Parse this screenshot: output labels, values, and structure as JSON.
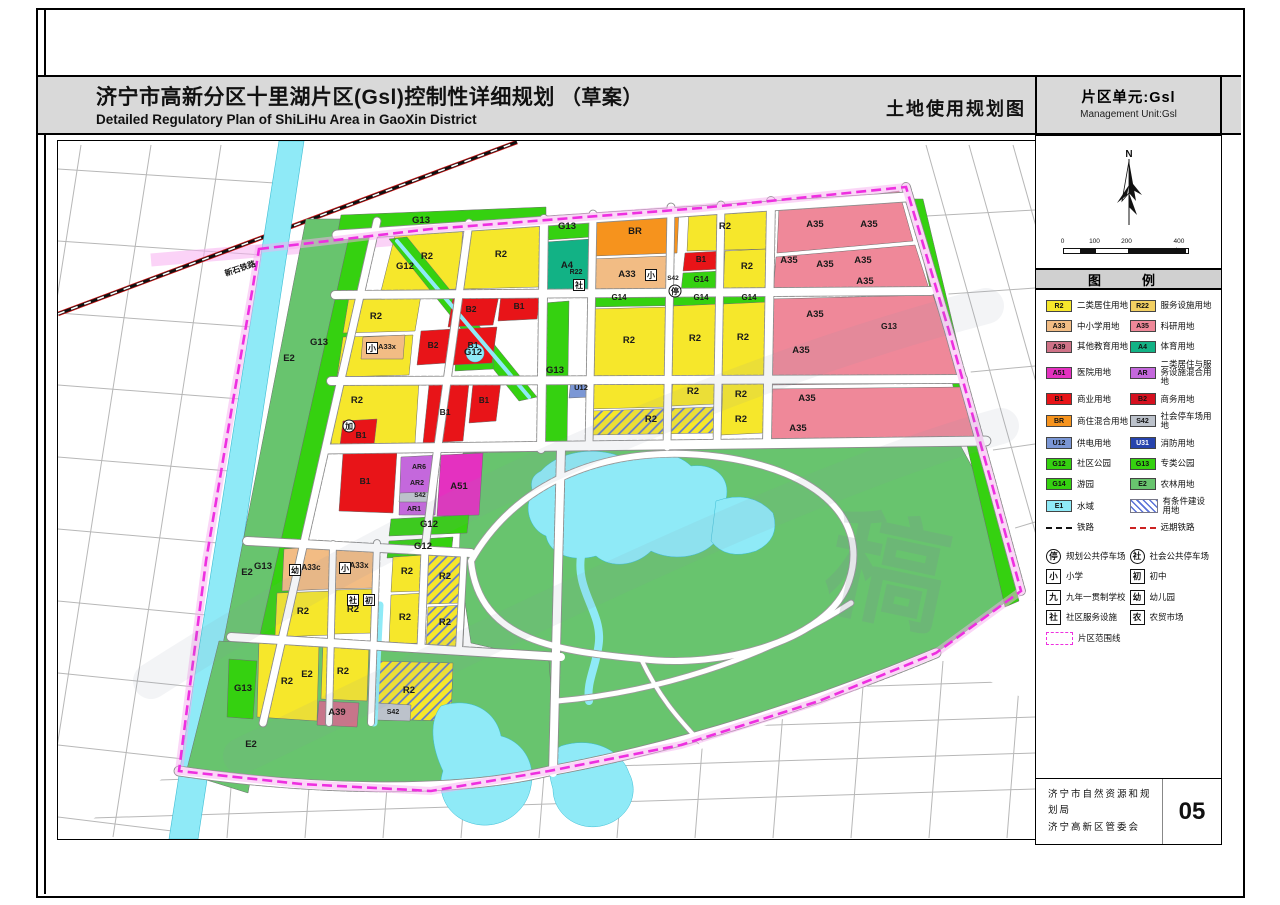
{
  "header": {
    "title_cn": "济宁市高新分区十里湖片区(Gsl)控制性详细规划",
    "title_draft": "（草案）",
    "title_en": "Detailed Regulatory Plan of ShiLiHu Area in GaoXin District",
    "map_name": "土地使用规划图",
    "unit_cn": "片区单元:Gsl",
    "unit_en": "Management Unit:Gsl"
  },
  "compass": {
    "north_label": "N"
  },
  "scale": {
    "labels": [
      {
        "t": "0",
        "x": 0
      },
      {
        "t": "100",
        "x": 32
      },
      {
        "t": "200",
        "x": 64
      },
      {
        "t": "400米",
        "x": 118
      }
    ],
    "segments": [
      {
        "w": 16,
        "b": 0
      },
      {
        "w": 16,
        "b": 1
      },
      {
        "w": 32,
        "b": 0
      },
      {
        "w": 58,
        "b": 1
      }
    ]
  },
  "legend": {
    "title": "图　例",
    "rows": [
      [
        {
          "code": "R2",
          "color": "#f6e72b",
          "label": "二类居住用地"
        },
        {
          "code": "R22",
          "color": "#f2cf62",
          "label": "服务设施用地"
        }
      ],
      [
        {
          "code": "A33",
          "color": "#f2bc84",
          "label": "中小学用地"
        },
        {
          "code": "A35",
          "color": "#ef8899",
          "label": "科研用地"
        }
      ],
      [
        {
          "code": "A39",
          "color": "#cf7287",
          "label": "其他教育用地"
        },
        {
          "code": "A4",
          "color": "#12b285",
          "label": "体育用地"
        }
      ],
      [
        {
          "code": "A51",
          "color": "#e431c0",
          "label": "医院用地"
        },
        {
          "code": "AR",
          "color": "#c468dc",
          "label": "二类居住与服务设施混合用地"
        }
      ],
      [
        {
          "code": "B1",
          "color": "#e81418",
          "label": "商业用地"
        },
        {
          "code": "B2",
          "color": "#d5101f",
          "label": "商务用地"
        }
      ],
      [
        {
          "code": "BR",
          "color": "#f6931d",
          "label": "商住混合用地"
        },
        {
          "code": "S42",
          "color": "#bcc2cb",
          "label": "社会停车场用地"
        }
      ],
      [
        {
          "code": "U12",
          "color": "#7b97d5",
          "label": "供电用地"
        },
        {
          "code": "U31",
          "color": "#2743ad",
          "label": "消防用地",
          "white": 1
        }
      ],
      [
        {
          "code": "G12",
          "color": "#35d110",
          "label": "社区公园"
        },
        {
          "code": "G13",
          "color": "#35d110",
          "label": "专类公园"
        }
      ],
      [
        {
          "code": "G14",
          "color": "#35d110",
          "label": "游园"
        },
        {
          "code": "E2",
          "color": "#68c46e",
          "label": "农林用地"
        }
      ],
      [
        {
          "code": "E1",
          "color": "#8feaf7",
          "label": "水域"
        },
        {
          "type": "hatch",
          "label": "有条件建设用地"
        }
      ],
      [
        {
          "type": "line-black",
          "label": "铁路"
        },
        {
          "type": "line-red",
          "label": "远期铁路"
        }
      ]
    ],
    "symbols": [
      [
        {
          "sym": "停",
          "circ": 1,
          "label": "规划公共停车场"
        },
        {
          "sym": "社",
          "circ": 1,
          "label": "社会公共停车场"
        }
      ],
      [
        {
          "sym": "小",
          "label": "小学"
        },
        {
          "sym": "初",
          "label": "初中"
        }
      ],
      [
        {
          "sym": "九",
          "label": "九年一贯制学校"
        },
        {
          "sym": "幼",
          "label": "幼儿园"
        }
      ],
      [
        {
          "sym": "社",
          "label": "社区服务设施"
        },
        {
          "sym": "农",
          "label": "农贸市场"
        }
      ]
    ],
    "boundary_item": {
      "label": "片区范围线"
    }
  },
  "footer": {
    "org1": "济宁市自然资源和规划局",
    "org2": "济宁高新区管委会",
    "page": "05"
  },
  "map": {
    "palette": {
      "R2": "#f6e72b",
      "R22": "#f2cf62",
      "A33": "#f2bc84",
      "A39": "#cf7287",
      "A35": "#ef8899",
      "A4": "#12b285",
      "A51": "#e431c0",
      "AR": "#c468dc",
      "B": "#e81418",
      "BR": "#f6931d",
      "S42": "#bcc2cb",
      "U12": "#7b97d5",
      "U31": "#2743ad",
      "G": "#35d110",
      "E2": "#68c46e",
      "E1": "#8feaf7",
      "bnd": "#ee2fe0",
      "bndBand": "#f8aef0",
      "rail": "#cf1212",
      "grid": "#b7b7b7",
      "hatch": "#5a72d8"
    },
    "river": "278,140 303,140 197,838 168,838",
    "railway": "M57,313 L516,141",
    "corridor": "M150,259 L562,224",
    "boundary": "M258,248 L430,228 L700,207 L905,186 L948,330 L990,480 L1020,590 L935,652 L818,700 L680,744 L548,770 L430,790 L300,783 L178,770 L205,560 L232,400 L252,285 Z",
    "parcels": [
      {
        "p": "305,218 352,218 247,792 196,776",
        "c": "E2"
      },
      {
        "p": "352,218 376,218 262,724 240,718",
        "c": "G"
      },
      {
        "d": "M218,640 L470,655 L560,660 L548,768 L430,790 L300,783 L185,772 Z",
        "c": "E2"
      },
      {
        "d": "M462,452 L958,442 L1002,522 L1020,590 L935,652 L818,700 L680,744 L556,770 L548,660 L470,642 L458,560 Z",
        "c": "E2"
      },
      {
        "p": "340,214 545,206 545,224 336,236",
        "c": "G"
      },
      {
        "d": "M908,198 L922,198 L1018,600 L1004,606 Z",
        "c": "G"
      },
      {
        "p": "545,216 590,213 590,236 545,239",
        "c": "G"
      },
      {
        "p": "543,302 568,300 566,444 541,446",
        "c": "G"
      },
      {
        "p": "228,658 256,660 252,718 226,716",
        "c": "G"
      },
      {
        "p": "396,226 462,224 458,288 380,290",
        "c": "R2"
      },
      {
        "p": "466,224 540,222 538,286 462,288",
        "c": "R2"
      },
      {
        "p": "348,296 420,294 414,330 342,332",
        "c": "R2"
      },
      {
        "p": "342,336 412,334 408,374 336,376",
        "c": "R2"
      },
      {
        "p": "362,336 404,334 402,358 360,358",
        "c": "A33"
      },
      {
        "p": "336,382 418,380 414,442 330,444",
        "c": "R2"
      },
      {
        "p": "342,420 376,418 373,444 339,444",
        "c": "B"
      },
      {
        "d": "M388,238 L406,236 L536,396 L518,400 Z",
        "c": "G"
      },
      {
        "p": "456,338 494,336 492,368 454,370",
        "c": "G"
      },
      {
        "p": "452,296 498,294 492,324 447,326",
        "c": "B"
      },
      {
        "p": "500,294 540,292 536,318 497,320",
        "c": "B"
      },
      {
        "p": "420,330 452,328 446,362 416,364",
        "c": "B"
      },
      {
        "p": "455,328 496,326 491,362 451,364",
        "c": "B"
      },
      {
        "p": "428,384 468,382 462,440 422,442",
        "c": "B"
      },
      {
        "p": "472,382 500,380 495,420 468,422",
        "c": "B"
      },
      {
        "p": "342,452 396,450 392,512 338,510",
        "c": "B"
      },
      {
        "p": "400,456 438,454 434,514 398,514",
        "c": "AR"
      },
      {
        "p": "399,492 434,491 433,501 398,501",
        "c": "S42"
      },
      {
        "p": "440,454 482,452 478,514 436,515",
        "c": "A51"
      },
      {
        "p": "390,518 468,514 466,532 388,535",
        "c": "G"
      },
      {
        "p": "388,540 452,536 450,554 386,557",
        "c": "G"
      },
      {
        "p": "595,212 678,208 676,252 593,255",
        "c": "BR"
      },
      {
        "p": "688,207 768,202 766,248 686,250",
        "c": "R2"
      },
      {
        "p": "684,252 722,250 720,268 682,270",
        "c": "B"
      },
      {
        "p": "682,272 720,270 718,290 680,291",
        "c": "G"
      },
      {
        "p": "724,250 766,248 764,288 722,290",
        "c": "R2"
      },
      {
        "p": "590,258 668,255 666,290 588,292",
        "c": "A33"
      },
      {
        "p": "566,260 588,258 586,291 564,292",
        "c": "R22"
      },
      {
        "p": "545,241 590,238 588,290 543,292",
        "c": "A4"
      },
      {
        "p": "590,294 768,290 766,303 588,306",
        "c": "G"
      },
      {
        "p": "590,308 668,306 666,376 588,378",
        "c": "R2"
      },
      {
        "p": "672,305 718,303 716,375 670,377",
        "c": "R2"
      },
      {
        "p": "722,303 766,301 764,374 720,376",
        "c": "R2"
      },
      {
        "p": "590,382 668,380 666,406 588,408",
        "c": "R2"
      },
      {
        "p": "590,410 716,406 714,432 588,434",
        "c": "R2",
        "h": 1
      },
      {
        "p": "672,379 716,377 714,403 670,405",
        "c": "R2"
      },
      {
        "p": "722,379 764,377 762,432 720,434",
        "c": "R2"
      },
      {
        "p": "570,378 592,376 590,396 568,397",
        "c": "U12"
      },
      {
        "p": "778,206 898,190 912,240 776,252",
        "c": "A35"
      },
      {
        "p": "775,256 914,244 928,288 772,294",
        "c": "A35"
      },
      {
        "p": "770,298 932,294 962,382 768,384",
        "c": "A35"
      },
      {
        "p": "768,388 963,386 976,436 766,440",
        "c": "A35"
      },
      {
        "p": "283,548 330,545 328,588 281,590",
        "c": "A33"
      },
      {
        "p": "335,545 375,543 373,587 333,588",
        "c": "A33"
      },
      {
        "p": "276,592 332,590 330,634 274,636",
        "c": "R2"
      },
      {
        "p": "335,589 374,588 372,632 333,633",
        "c": "R2"
      },
      {
        "p": "392,556 424,554 422,590 390,591",
        "c": "R2"
      },
      {
        "p": "427,553 464,551 462,602 425,603",
        "c": "R2",
        "h": 1
      },
      {
        "p": "390,594 424,592 422,642 388,643",
        "c": "R2"
      },
      {
        "p": "427,606 464,604 462,645 425,646",
        "c": "R2",
        "h": 1
      },
      {
        "p": "258,640 318,643 316,720 256,716",
        "c": "R2"
      },
      {
        "p": "322,643 368,645 366,700 320,698",
        "c": "R2"
      },
      {
        "p": "318,700 358,702 356,726 316,724",
        "c": "A39"
      },
      {
        "p": "372,660 452,662 450,720 370,718",
        "c": "R2",
        "h": 1
      },
      {
        "p": "376,702 410,704 409,720 375,719",
        "c": "S42"
      }
    ],
    "water": [
      {
        "d": "M396,240 L528,396",
        "w": 4
      },
      {
        "d": "M379,604 L373,722",
        "w": 7
      },
      {
        "d": "M540,470 C560,448 600,445 625,458 C645,448 675,450 690,465 C715,462 730,478 725,498 C740,512 735,532 715,540 C700,558 670,560 650,550 C635,565 610,568 595,555 C570,562 548,552 545,535 C528,528 522,505 532,492 C528,480 532,474 540,470 Z"
      },
      {
        "d": "M715,500 Q750,488 772,512 Q780,538 755,550 Q725,560 710,540 Z"
      },
      {
        "d": "M580,555 C575,590 600,610 598,640 C596,665 585,680 588,700",
        "w": 8
      },
      {
        "d": "M440,705 C470,695 495,710 500,735 C520,740 535,760 530,785 C525,815 495,830 470,822 C445,815 435,790 442,770 C430,745 428,720 440,705 Z"
      },
      {
        "d": "M560,745 C590,735 620,748 628,772 C640,795 625,820 600,825 C575,830 552,812 552,788 C545,765 548,752 560,745 Z"
      },
      {
        "d": "M474,343 a9,9 0 1,0 0.1,0 Z"
      }
    ],
    "roads": [
      {
        "d": "M336,234 L905,196",
        "w": 9
      },
      {
        "d": "M334,294 L930,290",
        "w": 8
      },
      {
        "d": "M330,380 L962,378",
        "w": 8
      },
      {
        "d": "M326,448 L985,440",
        "w": 9
      },
      {
        "d": "M376,220 L262,722",
        "w": 7
      },
      {
        "d": "M468,222 L436,452 L424,548 L420,645",
        "w": 7
      },
      {
        "d": "M543,218 L540,448",
        "w": 8
      },
      {
        "d": "M592,213 L588,446",
        "w": 7
      },
      {
        "d": "M670,206 L666,446",
        "w": 7
      },
      {
        "d": "M720,204 L716,444",
        "w": 7
      },
      {
        "d": "M770,200 L766,442",
        "w": 8
      },
      {
        "d": "M246,540 L470,552",
        "w": 8
      },
      {
        "d": "M230,636 L560,656",
        "w": 8
      },
      {
        "d": "M332,543 L328,722",
        "w": 6
      },
      {
        "d": "M376,542 L370,722",
        "w": 6
      },
      {
        "d": "M463,552 L458,648",
        "w": 6
      },
      {
        "d": "M560,448 L552,772",
        "w": 8
      },
      {
        "d": "M178,770 C300,788 450,794 548,770 C680,746 820,700 935,652",
        "w": 9
      },
      {
        "d": "M905,186 L948,330 L990,480 L1020,590",
        "w": 8
      },
      {
        "d": "M470,560 C520,472 620,442 720,456 C820,470 868,520 848,580 C828,640 720,668 640,658 C560,650 478,642 470,560",
        "w": 6,
        "p": 1
      },
      {
        "d": "M556,700 C650,692 760,660 850,602",
        "w": 5,
        "p": 1
      },
      {
        "d": "M640,658 C660,700 680,720 700,742",
        "w": 4,
        "p": 1
      }
    ],
    "labels": [
      [
        "G13",
        420,
        222
      ],
      [
        "G13",
        318,
        344
      ],
      [
        "G13",
        262,
        568
      ],
      [
        "G13",
        242,
        690
      ],
      [
        "G13",
        554,
        372
      ],
      [
        "G13",
        566,
        228
      ],
      [
        "G13",
        888,
        328,
        8.5
      ],
      [
        "E2",
        288,
        360
      ],
      [
        "E2",
        246,
        574
      ],
      [
        "E2",
        250,
        746
      ],
      [
        "E2",
        306,
        676
      ],
      [
        "G12",
        404,
        268
      ],
      [
        "G12",
        472,
        354
      ],
      [
        "G12",
        428,
        526
      ],
      [
        "G12",
        422,
        548
      ],
      [
        "G14",
        618,
        299,
        8
      ],
      [
        "G14",
        700,
        281,
        8
      ],
      [
        "G14",
        700,
        299,
        8
      ],
      [
        "G14",
        748,
        299,
        8
      ],
      [
        "A4",
        566,
        267
      ],
      [
        "R2",
        426,
        258
      ],
      [
        "R2",
        500,
        256
      ],
      [
        "R2",
        375,
        318
      ],
      [
        "R2",
        356,
        402
      ],
      [
        "R2",
        302,
        613
      ],
      [
        "R2",
        352,
        611
      ],
      [
        "R2",
        406,
        573
      ],
      [
        "R2",
        444,
        578
      ],
      [
        "R2",
        404,
        619
      ],
      [
        "R2",
        444,
        624
      ],
      [
        "R2",
        286,
        683
      ],
      [
        "R2",
        342,
        673
      ],
      [
        "R2",
        408,
        692
      ],
      [
        "R2",
        628,
        342
      ],
      [
        "R2",
        694,
        340
      ],
      [
        "R2",
        742,
        339
      ],
      [
        "R2",
        692,
        393
      ],
      [
        "R2",
        740,
        396
      ],
      [
        "R2",
        650,
        421
      ],
      [
        "R2",
        740,
        421
      ],
      [
        "R2",
        724,
        228
      ],
      [
        "R2",
        746,
        268
      ],
      [
        "A35",
        814,
        226
      ],
      [
        "A35",
        868,
        226
      ],
      [
        "A35",
        788,
        262
      ],
      [
        "A35",
        824,
        266
      ],
      [
        "A35",
        862,
        262
      ],
      [
        "A35",
        864,
        283
      ],
      [
        "A35",
        814,
        316
      ],
      [
        "A35",
        800,
        352
      ],
      [
        "A35",
        806,
        400
      ],
      [
        "A35",
        797,
        430
      ],
      [
        "B2",
        470,
        311,
        8.5
      ],
      [
        "B1",
        518,
        308,
        8.5
      ],
      [
        "B2",
        432,
        347,
        8.5
      ],
      [
        "B1",
        472,
        347,
        8.5
      ],
      [
        "B1",
        360,
        437,
        8.5
      ],
      [
        "B1",
        444,
        414,
        8.5
      ],
      [
        "B1",
        483,
        402,
        8
      ],
      [
        "B1",
        364,
        483,
        8.5
      ],
      [
        "B1",
        700,
        261,
        8
      ],
      [
        "BR",
        634,
        233
      ],
      [
        "A33",
        626,
        276
      ],
      [
        "R22",
        575,
        273,
        7
      ],
      [
        "A33c",
        310,
        569,
        8
      ],
      [
        "A33x",
        358,
        567,
        8
      ],
      [
        "A33x",
        386,
        348,
        7.5
      ],
      [
        "A39",
        336,
        714
      ],
      [
        "A51",
        458,
        488
      ],
      [
        "AR6",
        418,
        468,
        7
      ],
      [
        "AR2",
        416,
        484,
        7
      ],
      [
        "S42",
        419,
        496,
        6.5
      ],
      [
        "AR1",
        413,
        510,
        7
      ],
      [
        "S42",
        392,
        713,
        7
      ],
      [
        "S42",
        672,
        279,
        6.5
      ],
      [
        "U12",
        580,
        389,
        7.5
      ],
      [
        "新石铁路",
        240,
        270,
        8,
        -19
      ]
    ],
    "markers": [
      {
        "ch": "小",
        "x": 650,
        "y": 274
      },
      {
        "ch": "社",
        "x": 578,
        "y": 284
      },
      {
        "ch": "幼",
        "x": 294,
        "y": 569
      },
      {
        "ch": "小",
        "x": 344,
        "y": 567
      },
      {
        "ch": "社",
        "x": 352,
        "y": 599
      },
      {
        "ch": "初",
        "x": 368,
        "y": 599
      },
      {
        "ch": "小",
        "x": 371,
        "y": 347
      },
      {
        "ch": "加",
        "x": 348,
        "y": 425,
        "circ": 1
      },
      {
        "ch": "停",
        "x": 674,
        "y": 290,
        "circ": 1
      }
    ],
    "watermark": {
      "strokes": [
        "M150,680 C400,520 700,380 985,305",
        "M240,755 C500,630 800,480 1000,425"
      ],
      "char": {
        "t": "稿",
        "x": 878,
        "y": 612,
        "fs": 120,
        "rot": 12
      }
    }
  }
}
